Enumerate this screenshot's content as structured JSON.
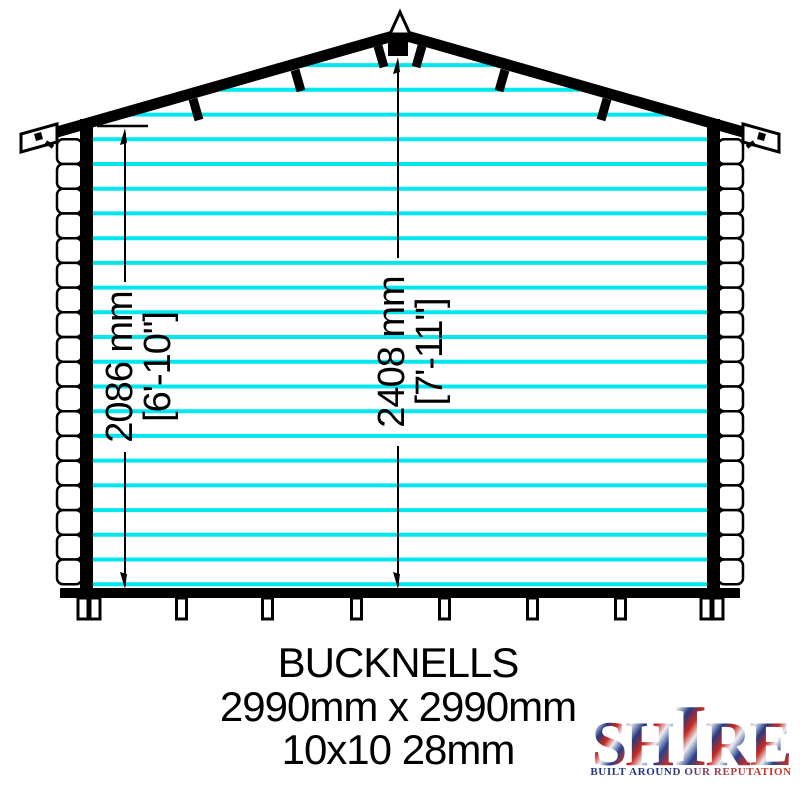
{
  "drawing": {
    "type": "log-cabin-front-elevation",
    "dimensions": {
      "eaves_height": {
        "mm": "2086 mm",
        "imperial": "[6'-10\"]"
      },
      "ridge_height": {
        "mm": "2408 mm",
        "imperial": "[7'-11\"]"
      }
    },
    "colors": {
      "cladding": "#00E7F0",
      "outline": "#000000",
      "background": "#FFFFFF"
    }
  },
  "caption": {
    "product_name": "BUCKNELLS",
    "size_mm": "2990mm x 2990mm",
    "size_nominal": "10x10 28mm"
  },
  "logo": {
    "brand": "SHIRE",
    "tagline": "BUILT AROUND OUR REPUTATION",
    "colors": {
      "red": "#C0392B",
      "blue": "#24377E",
      "white": "#E9EAF2"
    }
  }
}
